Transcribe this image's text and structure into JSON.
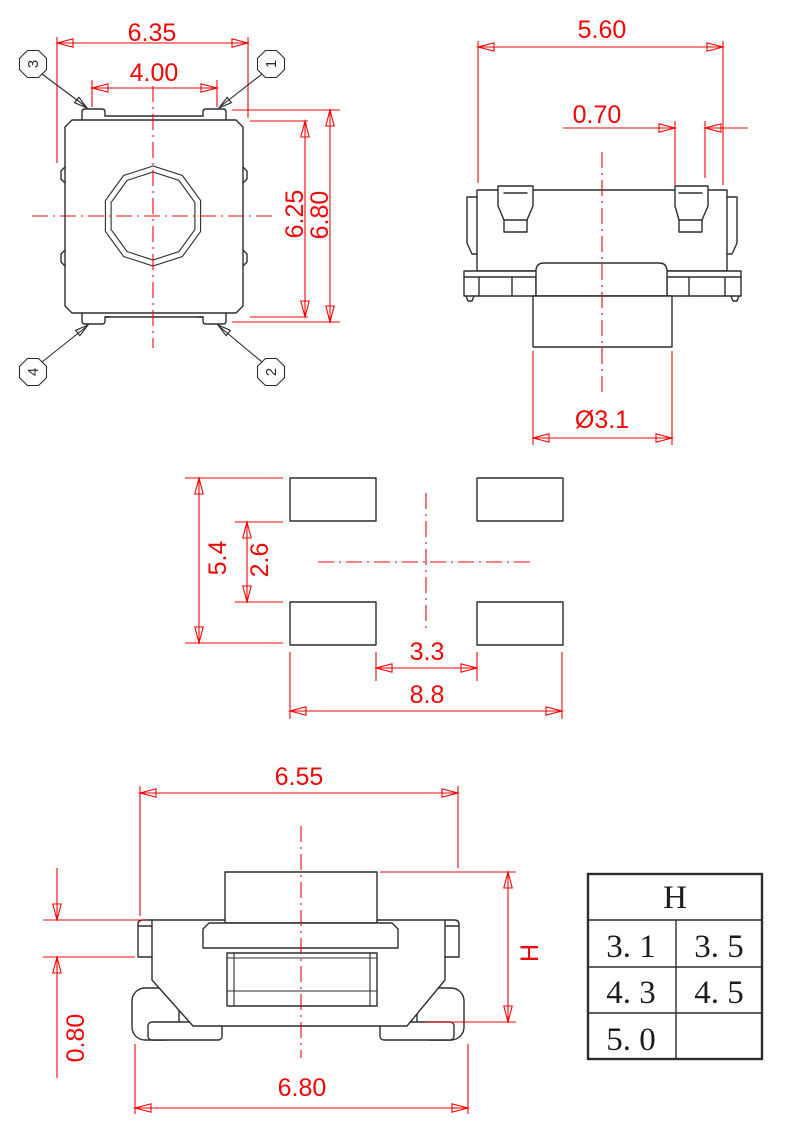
{
  "colors": {
    "dimension_red": "#f30505",
    "line_black": "#2d2d2d",
    "background": "#ffffff"
  },
  "top_view": {
    "dim_overall_width": "6.35",
    "dim_lug_spacing": "4.00",
    "dim_body_height": "6.25",
    "dim_overall_height": "6.80",
    "pin_top_left": "3",
    "pin_top_right": "1",
    "pin_bottom_left": "4",
    "pin_bottom_right": "2"
  },
  "side_view": {
    "dim_overall_width": "5.60",
    "dim_lug_width": "0.70",
    "dim_stem_diameter": "Ø3.1"
  },
  "land_pattern": {
    "dim_pad_span_vertical": "5.4",
    "dim_pad_gap_vertical": "2.6",
    "dim_pad_gap_horizontal": "3.3",
    "dim_pad_span_horizontal": "8.8"
  },
  "front_view": {
    "dim_cap_width": "6.55",
    "dim_lip_height": "0.80",
    "dim_base_width": "6.80",
    "dim_height_label": "H"
  },
  "height_table": {
    "header": "H",
    "rows": [
      [
        "3. 1",
        "3. 5"
      ],
      [
        "4. 3",
        "4. 5"
      ],
      [
        "5. 0",
        ""
      ]
    ]
  }
}
